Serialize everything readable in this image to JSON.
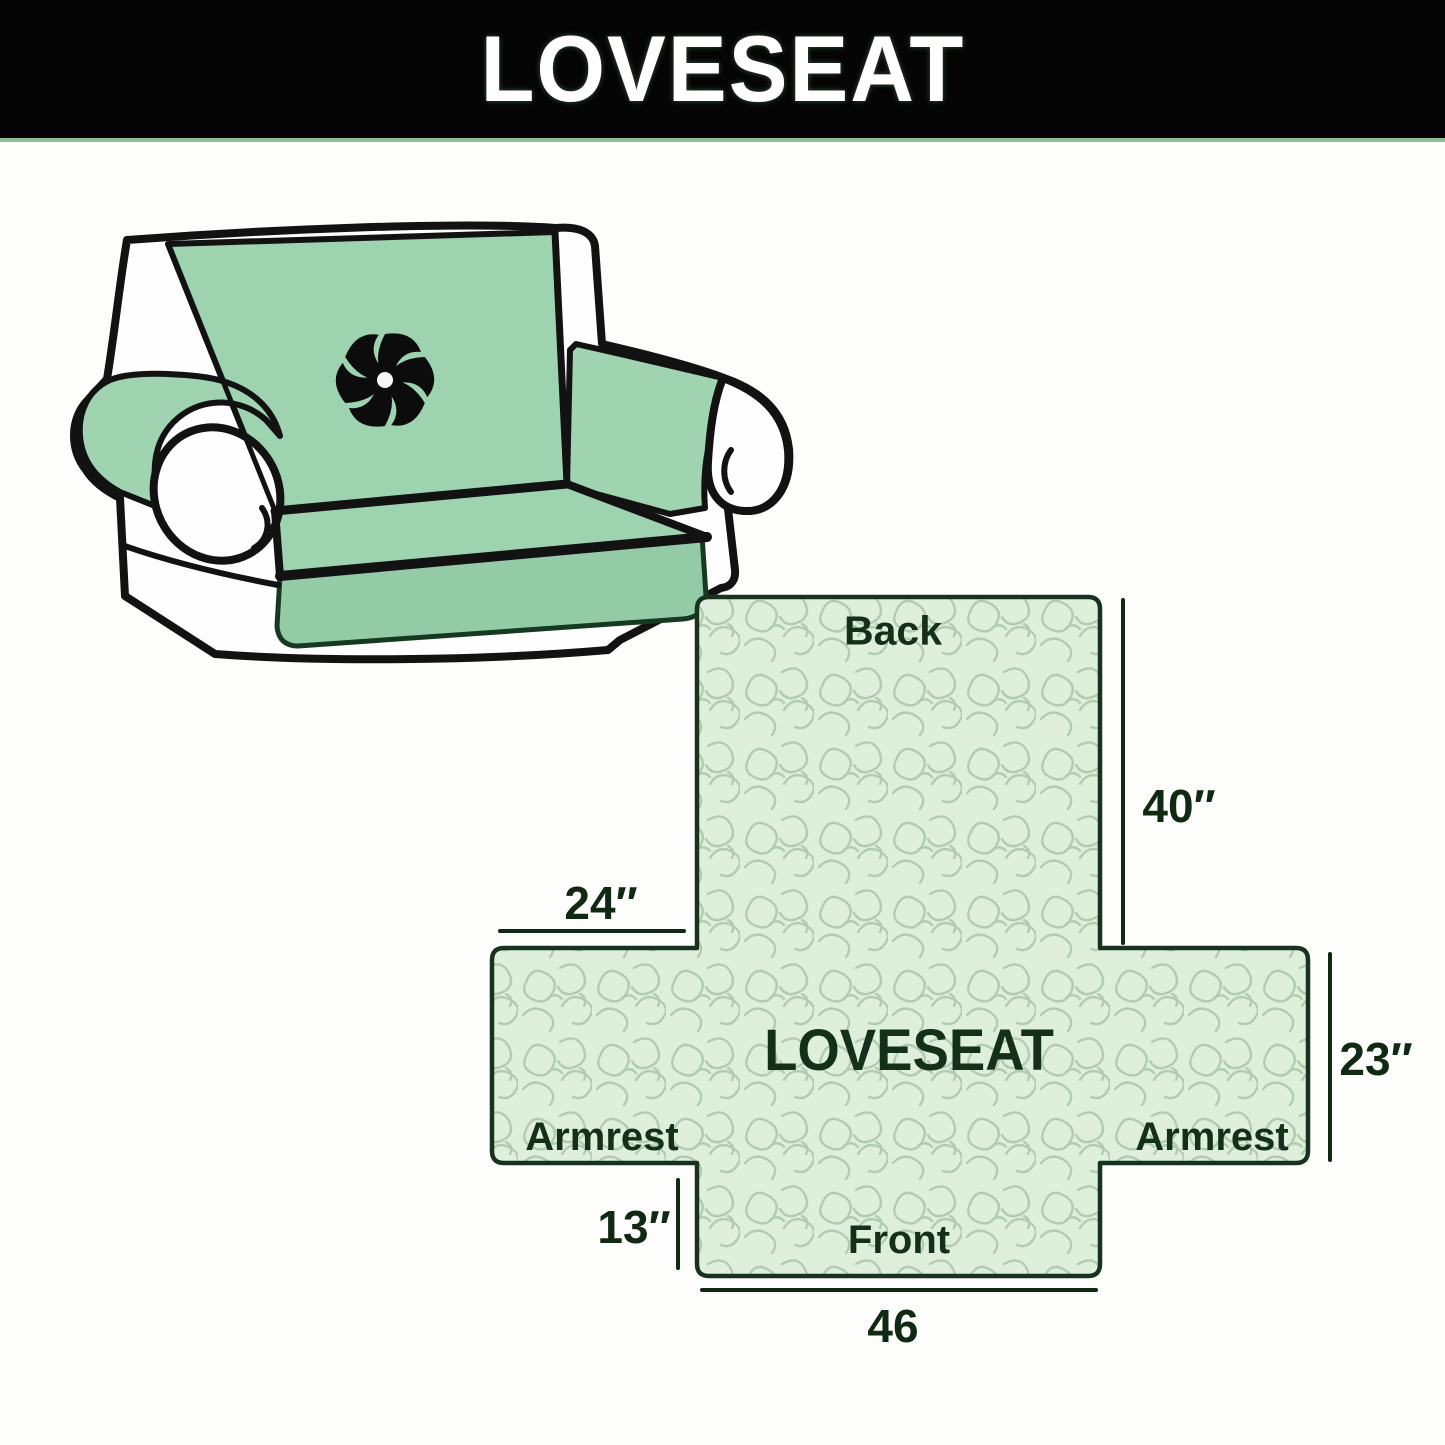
{
  "banner": {
    "title": "LOVESEAT"
  },
  "illustration": {
    "description": "loveseat sofa with mint green protective cover",
    "logo": "pinwheel"
  },
  "diagram": {
    "labels": {
      "back": "Back",
      "center": "LOVESEAT",
      "armrest_left": "Armrest",
      "armrest_right": "Armrest",
      "front": "Front"
    },
    "dims": {
      "back_height": "40″",
      "armrest_top_width": "24″",
      "side_height": "23″",
      "front_side_height": "13″",
      "front_width": "46"
    }
  },
  "colors": {
    "banner_bg": "#050505",
    "banner_text": "#ffffff",
    "cover_green": "#9dd2af",
    "pattern_bg": "#def0dc",
    "pattern_line": "#b3ccb1",
    "outline": "#17331d",
    "label_text": "#14301a"
  }
}
